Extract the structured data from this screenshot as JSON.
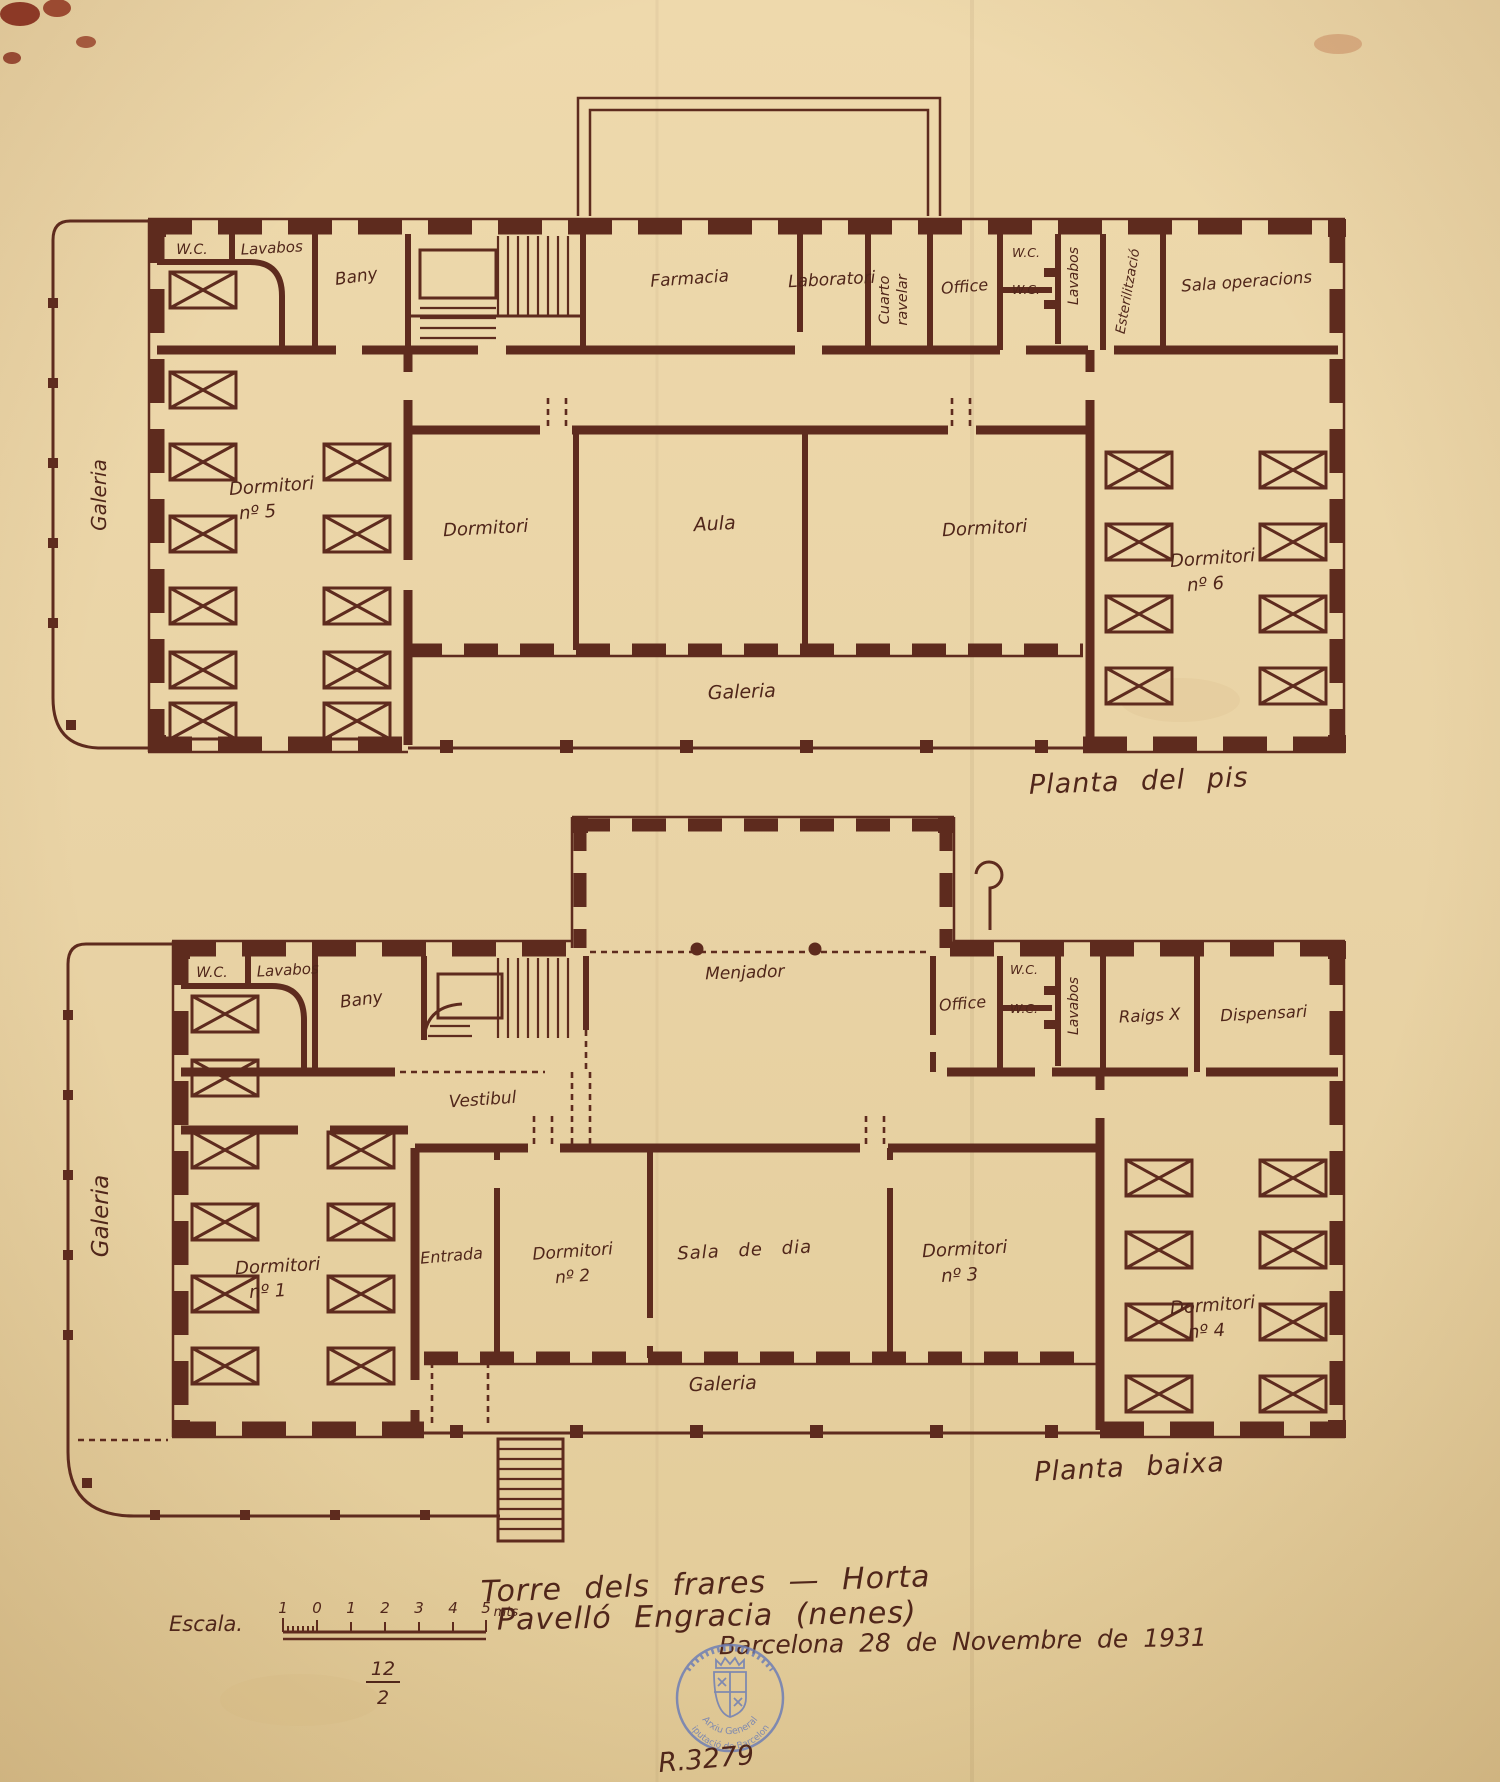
{
  "colors": {
    "paper": "#e9d3a5",
    "ink": "#5e2b1e",
    "stamp_blue": "#6f7fb5"
  },
  "plan_upper": {
    "caption": "Planta del pis",
    "gallery_left": "Galeria",
    "gallery_bottom": "Galeria",
    "rooms": {
      "wc": "W.C.",
      "lavabos": "Lavabos",
      "bany": "Bany",
      "farmacia": "Farmacia",
      "laboratori": "Laboratori",
      "cuarto_revelar": [
        "Cuarto",
        "ravelar"
      ],
      "office": "Office",
      "wc_a": "W.C.",
      "wc_b": "W.C.",
      "lavabos2": "Lavabos",
      "esterilitzacio": "Esterilització",
      "sala_operacions": "Sala operacions",
      "dormitori5": [
        "Dormitori",
        "nº 5"
      ],
      "dormitori_mid_left": "Dormitori",
      "aula": "Aula",
      "dormitori_mid_right": "Dormitori",
      "dormitori6": [
        "Dormitori",
        "nº 6"
      ]
    }
  },
  "plan_lower": {
    "caption": "Planta baixa",
    "gallery_left": "Galeria",
    "gallery_bottom": "Galeria",
    "rooms": {
      "wc": "W.C.",
      "lavabos": "Lavabos",
      "bany": "Bany",
      "menjador": "Menjador",
      "office": "Office",
      "wc_a": "W.C.",
      "wc_b": "W.C.",
      "lavabos2": "Lavabos",
      "raigs_x": "Raigs X",
      "dispensari": "Dispensari",
      "vestibul": "Vestibul",
      "entrada": "Entrada",
      "dormitori1": [
        "Dormitori",
        "nº 1"
      ],
      "dormitori2": [
        "Dormitori",
        "nº 2"
      ],
      "sala_de_dia": "Sala de dia",
      "dormitori3": [
        "Dormitori",
        "nº 3"
      ],
      "dormitori4": [
        "Dormitori",
        "nº 4"
      ]
    }
  },
  "footer": {
    "title_line1": "Torre dels frares — Horta",
    "title_line2": "Pavelló Engracia (nenes)",
    "scale_label": "Escala.",
    "scale_ticks": [
      "1",
      "0",
      "1",
      "2",
      "3",
      "4",
      "5"
    ],
    "scale_unit": "mts.",
    "fraction_numerator": "12",
    "fraction_denominator": "2",
    "date_line": "Barcelona 28 de Novembre de 1931",
    "stamp_line1": "Arxiu General",
    "stamp_line2": "Diputació de Barcelona",
    "registry_number": "R.3279"
  }
}
